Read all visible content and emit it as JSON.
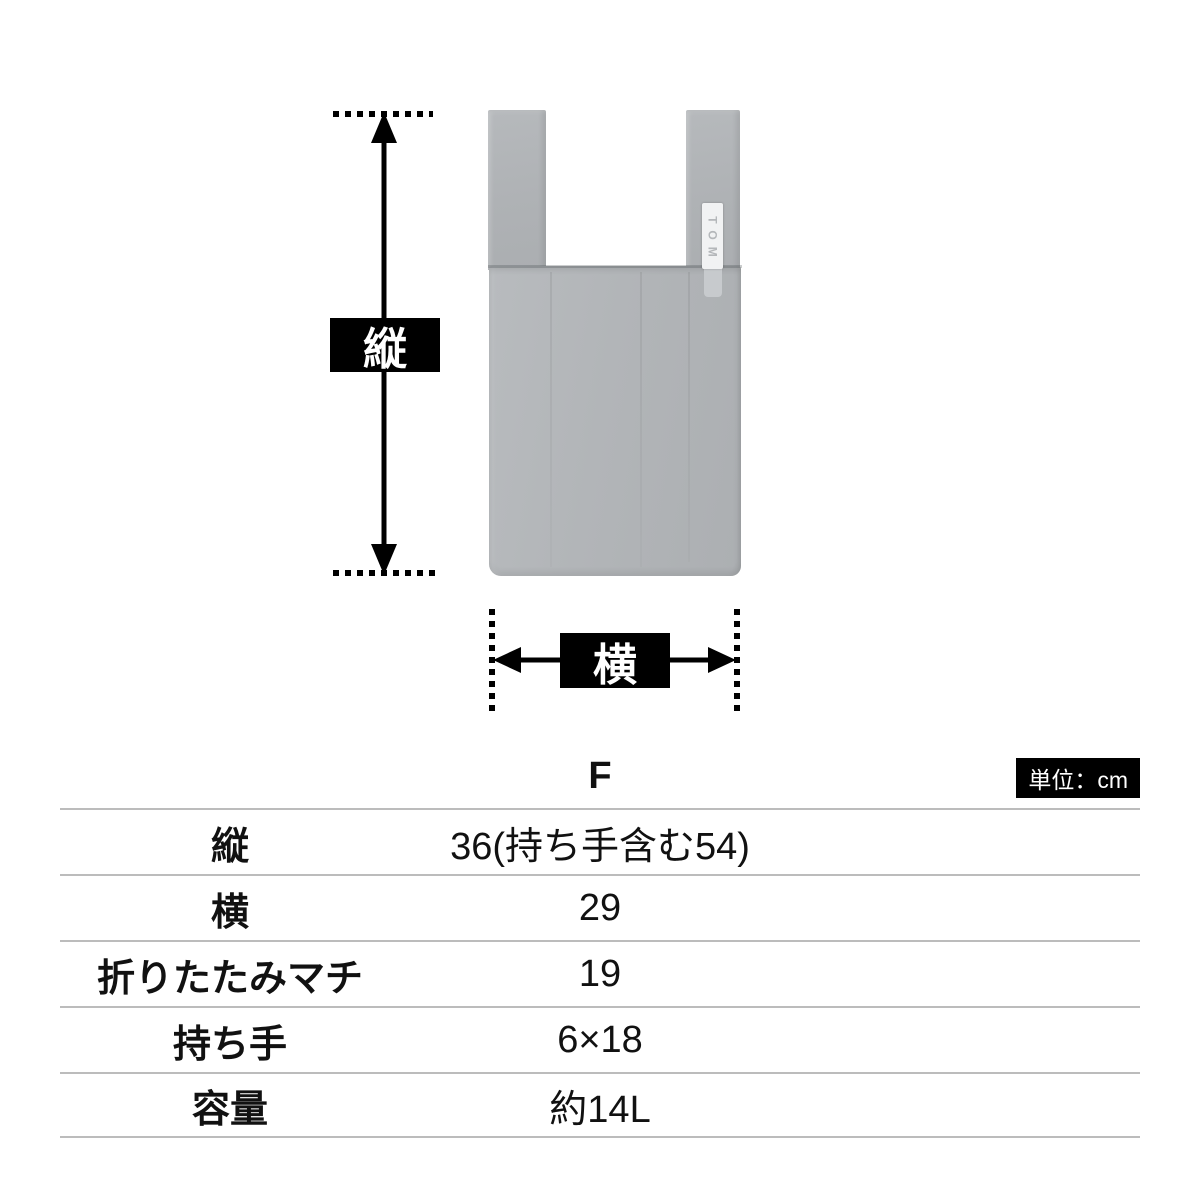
{
  "colors": {
    "accent_black": "#000000",
    "bag_gray": "#b2b5b8",
    "table_line_gray": "#bcbcbc",
    "text_dark": "#111111",
    "tag_white": "#f1f2f3"
  },
  "diagram": {
    "height_label": "縦",
    "width_label": "横",
    "brand_tag": "TOM"
  },
  "table": {
    "size_header": "F",
    "unit_badge": "単位：cm",
    "rows": [
      {
        "label": "縦",
        "value": "36(持ち手含む54)"
      },
      {
        "label": "横",
        "value": "29"
      },
      {
        "label": "折りたたみマチ",
        "value": "19"
      },
      {
        "label": "持ち手",
        "value": "6×18"
      },
      {
        "label": "容量",
        "value": "約14L"
      }
    ]
  }
}
